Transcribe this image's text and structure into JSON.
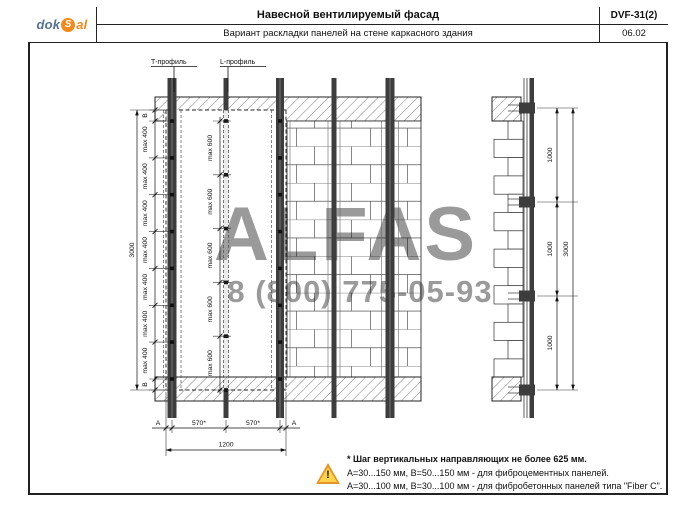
{
  "header": {
    "logo": {
      "part1": "dok",
      "part2": "S",
      "part3": "al"
    },
    "title": "Навесной вентилируемый фасад",
    "subtitle": "Вариант раскладки панелей на стене каркасного здания",
    "doc_code": "DVF-31(2)",
    "sheet_number": "06.02"
  },
  "drawing": {
    "profile_labels": {
      "t_profile": "Т-профиль",
      "l_profile": "L-профиль"
    },
    "front_view": {
      "left_chain": {
        "edge_top": "B",
        "edge_bottom": "B",
        "segments": [
          "max 400",
          "max 400",
          "max 400",
          "max 400",
          "max 400",
          "max 400",
          "max 400"
        ],
        "overall": "3000"
      },
      "mid_chain": {
        "segments": [
          "max 600",
          "max 600",
          "max 600",
          "max 600",
          "max 600"
        ]
      },
      "bottom_dims": {
        "edge_left": "A",
        "edge_right": "A",
        "span_1": "570*",
        "span_2": "570*",
        "overall": "1200"
      }
    },
    "section_view": {
      "segments": [
        "1000",
        "1000",
        "1000"
      ],
      "overall": "3000"
    }
  },
  "watermark": {
    "line1": "ALFAS",
    "line2": "8 (800) 775-05-93"
  },
  "notes": {
    "line1": "* Шаг вертикальных направляющих не более 625 мм.",
    "line2": "А=30...150 мм, В=50...150 мм - для фиброцементных панелей.",
    "line3": "А=30...100 мм, В=30...100 мм - для фибробетонных панелей типа \"Fiber C\"."
  }
}
